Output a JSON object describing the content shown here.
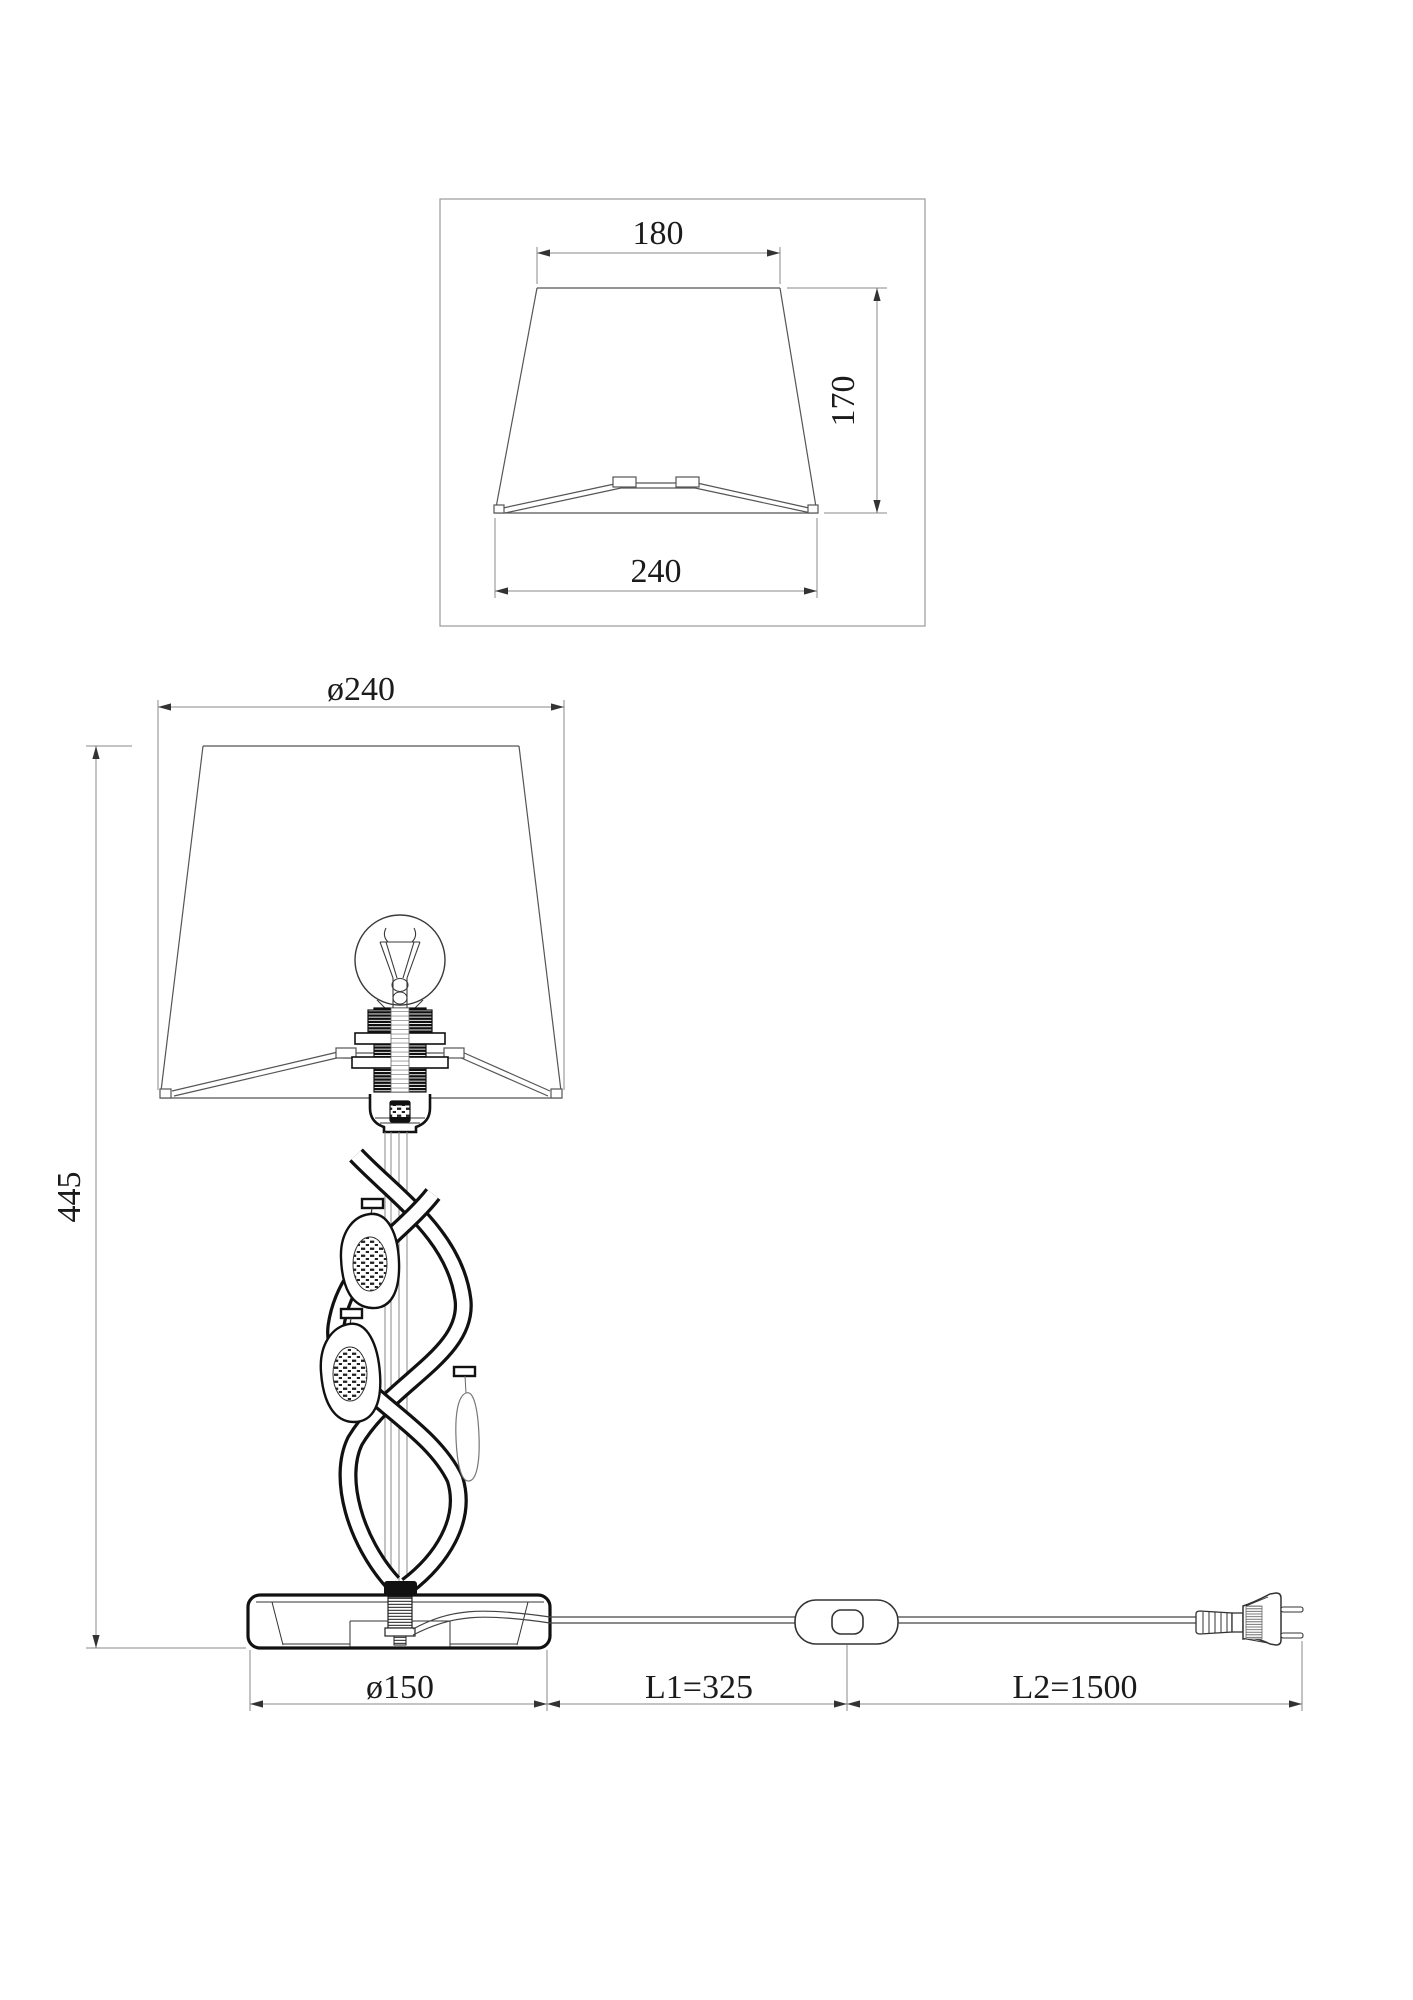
{
  "drawing": {
    "shade_detail_view": {
      "top_width": "180",
      "height": "170",
      "bottom_width": "240"
    },
    "lamp_front_view": {
      "shade_diameter": "ø240",
      "total_height": "445",
      "base_diameter": "ø150",
      "cord_length_1": "L1=325",
      "cord_length_2": "L2=1500"
    },
    "colors": {
      "background": "#ffffff",
      "object_line": "#4a4a4a",
      "heavy_line": "#111111",
      "dimension_line": "#8a8a8a",
      "text": "#1b1b1b"
    }
  }
}
